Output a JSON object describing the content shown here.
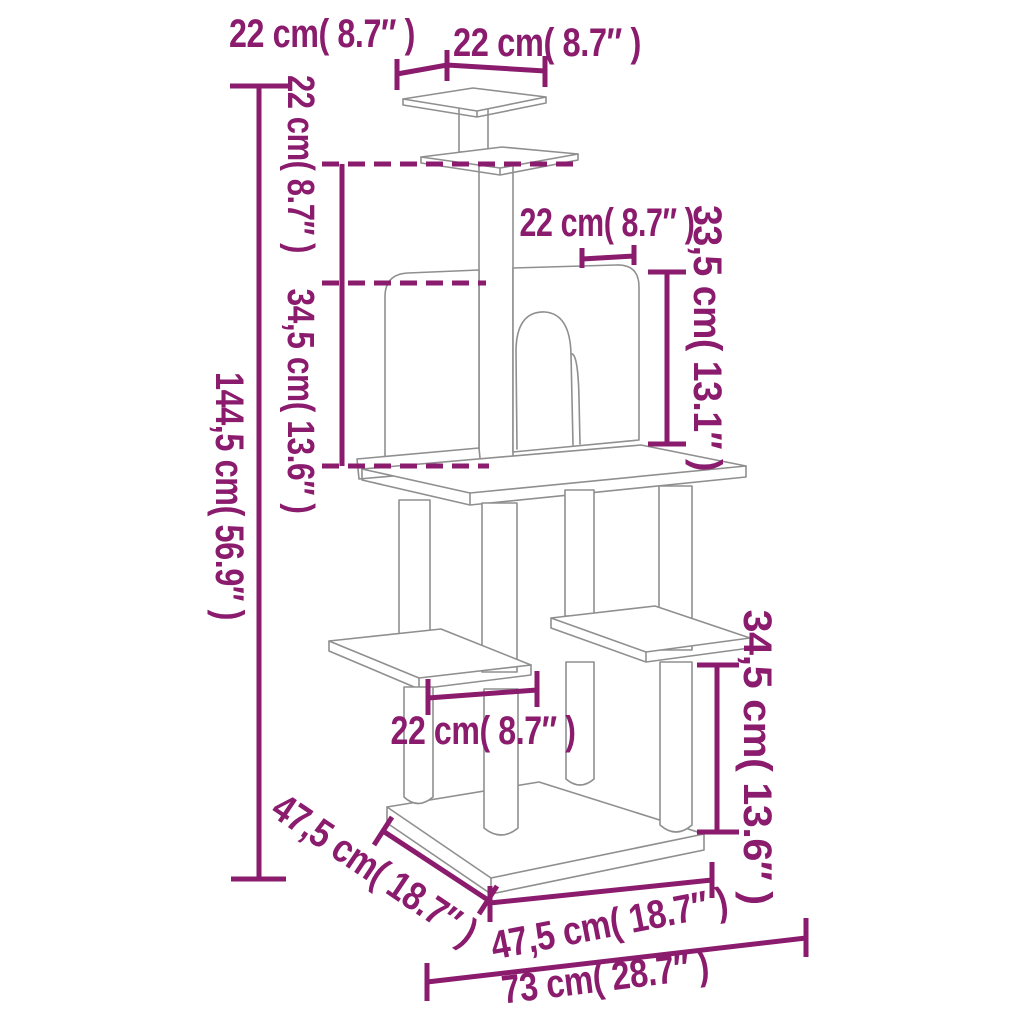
{
  "diagram": {
    "type": "product-dimension-diagram",
    "subject": "cat tree with scratching posts",
    "accent_color": "#8a1b6d",
    "outline_color": "#8f8f8f",
    "labels": {
      "top_platform_depth": "22 cm( 8.7″ )",
      "top_platform_width": "22 cm( 8.7″ )",
      "top_post_height": "22 cm( 8.7″ )",
      "condo_height": "34,5 cm( 13.6″ )",
      "total_height": "144,5 cm( 56.9″ )",
      "door_width": "22 cm( 8.7″ )",
      "condo_side_height": "33,5 cm( 13.1″ )",
      "platform_spacing": "22 cm( 8.7″ )",
      "lower_section_height": "34,5 cm( 13.6″ )",
      "base_depth": "47,5 cm( 18.7″ )",
      "base_width": "47,5 cm( 18.7″ )",
      "overall_width": "73 cm( 28.7″ )"
    }
  }
}
